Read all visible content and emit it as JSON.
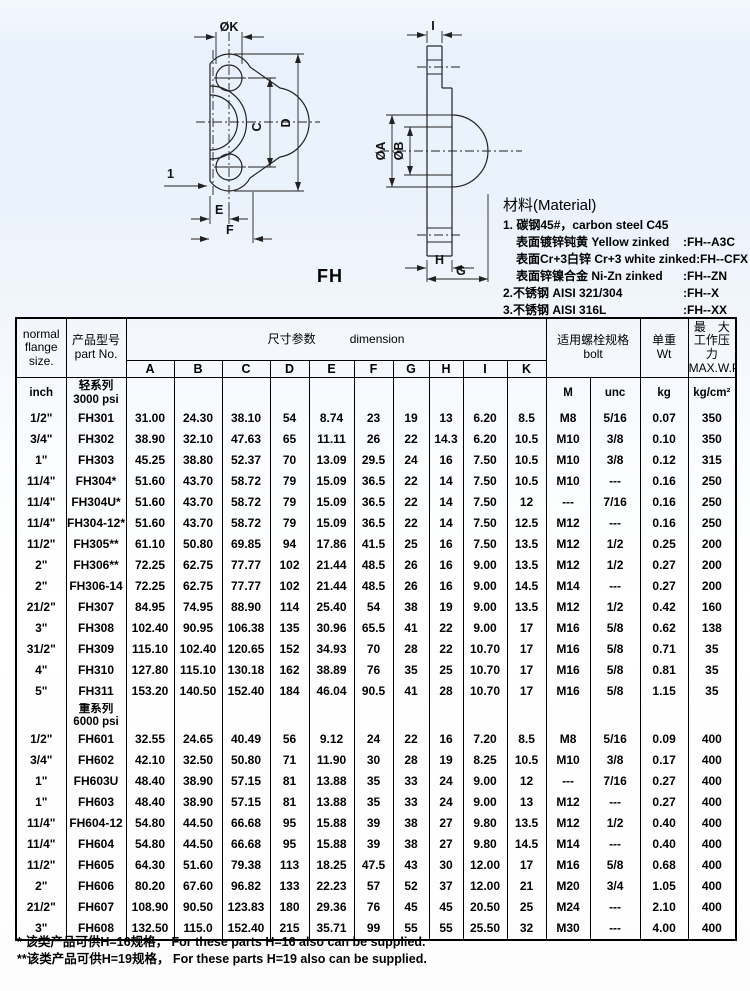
{
  "page": {
    "title": "FH"
  },
  "drawing": {
    "front": {
      "dia_k": "ØK",
      "c": "C",
      "d": "D",
      "chamfer": "1",
      "e": "E",
      "f": "F"
    },
    "side": {
      "i": "I",
      "dia_a": "ØA",
      "dia_b": "ØB",
      "h": "H",
      "g": "G"
    }
  },
  "material": {
    "heading": "材料(Material)",
    "lines": [
      {
        "text": "1. 碳钢45#，carbon steel  C45",
        "code": ""
      },
      {
        "text": "表面镀锌钝黄  Yellow zinked",
        "code": ":FH--A3C"
      },
      {
        "text": "表面Cr+3白锌  Cr+3 white zinked",
        "code": ":FH--CFX"
      },
      {
        "text": "表面锌镍合金  Ni-Zn zinked",
        "code": ":FH--ZN"
      },
      {
        "text": "2.不锈钢  AISI 321/304",
        "code": ":FH--X"
      },
      {
        "text": "3.不锈钢  AISI 316L",
        "code": ":FH--XX"
      }
    ]
  },
  "table": {
    "headers": {
      "size": "normal\nflange\nsize.",
      "part": "产品型号\npart No.",
      "dim_cn": "尺寸参数",
      "dim_en": "dimension",
      "bolt": "适用螺栓规格\nbolt",
      "wt": "单重\nWt",
      "maxwp": "最　大\n工作压力\nMAX.W.P"
    },
    "dim_letters": [
      "A",
      "B",
      "C",
      "D",
      "E",
      "F",
      "G",
      "H",
      "I",
      "K"
    ],
    "units_row": [
      "inch",
      "轻系列\n3000 psi",
      "",
      "",
      "",
      "",
      "",
      "",
      "",
      "",
      "",
      "",
      "M",
      "unc",
      "kg",
      "kg/cm²"
    ],
    "rows_light": [
      [
        "1/2\"",
        "FH301",
        "31.00",
        "24.30",
        "38.10",
        "54",
        "8.74",
        "23",
        "19",
        "13",
        "6.20",
        "8.5",
        "M8",
        "5/16",
        "0.07",
        "350"
      ],
      [
        "3/4\"",
        "FH302",
        "38.90",
        "32.10",
        "47.63",
        "65",
        "11.11",
        "26",
        "22",
        "14.3",
        "6.20",
        "10.5",
        "M10",
        "3/8",
        "0.10",
        "350"
      ],
      [
        "1\"",
        "FH303",
        "45.25",
        "38.80",
        "52.37",
        "70",
        "13.09",
        "29.5",
        "24",
        "16",
        "7.50",
        "10.5",
        "M10",
        "3/8",
        "0.12",
        "315"
      ],
      [
        "11/4\"",
        "FH304*",
        "51.60",
        "43.70",
        "58.72",
        "79",
        "15.09",
        "36.5",
        "22",
        "14",
        "7.50",
        "10.5",
        "M10",
        "---",
        "0.16",
        "250"
      ],
      [
        "11/4\"",
        "FH304U*",
        "51.60",
        "43.70",
        "58.72",
        "79",
        "15.09",
        "36.5",
        "22",
        "14",
        "7.50",
        "12",
        "---",
        "7/16",
        "0.16",
        "250"
      ],
      [
        "11/4\"",
        "FH304-12*",
        "51.60",
        "43.70",
        "58.72",
        "79",
        "15.09",
        "36.5",
        "22",
        "14",
        "7.50",
        "12.5",
        "M12",
        "---",
        "0.16",
        "250"
      ],
      [
        "11/2\"",
        "FH305**",
        "61.10",
        "50.80",
        "69.85",
        "94",
        "17.86",
        "41.5",
        "25",
        "16",
        "7.50",
        "13.5",
        "M12",
        "1/2",
        "0.25",
        "200"
      ],
      [
        "2\"",
        "FH306**",
        "72.25",
        "62.75",
        "77.77",
        "102",
        "21.44",
        "48.5",
        "26",
        "16",
        "9.00",
        "13.5",
        "M12",
        "1/2",
        "0.27",
        "200"
      ],
      [
        "2\"",
        "FH306-14",
        "72.25",
        "62.75",
        "77.77",
        "102",
        "21.44",
        "48.5",
        "26",
        "16",
        "9.00",
        "14.5",
        "M14",
        "---",
        "0.27",
        "200"
      ],
      [
        "21/2\"",
        "FH307",
        "84.95",
        "74.95",
        "88.90",
        "114",
        "25.40",
        "54",
        "38",
        "19",
        "9.00",
        "13.5",
        "M12",
        "1/2",
        "0.42",
        "160"
      ],
      [
        "3\"",
        "FH308",
        "102.40",
        "90.95",
        "106.38",
        "135",
        "30.96",
        "65.5",
        "41",
        "22",
        "9.00",
        "17",
        "M16",
        "5/8",
        "0.62",
        "138"
      ],
      [
        "31/2\"",
        "FH309",
        "115.10",
        "102.40",
        "120.65",
        "152",
        "34.93",
        "70",
        "28",
        "22",
        "10.70",
        "17",
        "M16",
        "5/8",
        "0.71",
        "35"
      ],
      [
        "4\"",
        "FH310",
        "127.80",
        "115.10",
        "130.18",
        "162",
        "38.89",
        "76",
        "35",
        "25",
        "10.70",
        "17",
        "M16",
        "5/8",
        "0.81",
        "35"
      ],
      [
        "5\"",
        "FH311",
        "153.20",
        "140.50",
        "152.40",
        "184",
        "46.04",
        "90.5",
        "41",
        "28",
        "10.70",
        "17",
        "M16",
        "5/8",
        "1.15",
        "35"
      ]
    ],
    "series_row": [
      "",
      "重系列\n6000 psi",
      "",
      "",
      "",
      "",
      "",
      "",
      "",
      "",
      "",
      "",
      "",
      "",
      "",
      ""
    ],
    "rows_heavy": [
      [
        "1/2\"",
        "FH601",
        "32.55",
        "24.65",
        "40.49",
        "56",
        "9.12",
        "24",
        "22",
        "16",
        "7.20",
        "8.5",
        "M8",
        "5/16",
        "0.09",
        "400"
      ],
      [
        "3/4\"",
        "FH602",
        "42.10",
        "32.50",
        "50.80",
        "71",
        "11.90",
        "30",
        "28",
        "19",
        "8.25",
        "10.5",
        "M10",
        "3/8",
        "0.17",
        "400"
      ],
      [
        "1\"",
        "FH603U",
        "48.40",
        "38.90",
        "57.15",
        "81",
        "13.88",
        "35",
        "33",
        "24",
        "9.00",
        "12",
        "---",
        "7/16",
        "0.27",
        "400"
      ],
      [
        "1\"",
        "FH603",
        "48.40",
        "38.90",
        "57.15",
        "81",
        "13.88",
        "35",
        "33",
        "24",
        "9.00",
        "13",
        "M12",
        "---",
        "0.27",
        "400"
      ],
      [
        "11/4\"",
        "FH604-12",
        "54.80",
        "44.50",
        "66.68",
        "95",
        "15.88",
        "39",
        "38",
        "27",
        "9.80",
        "13.5",
        "M12",
        "1/2",
        "0.40",
        "400"
      ],
      [
        "11/4\"",
        "FH604",
        "54.80",
        "44.50",
        "66.68",
        "95",
        "15.88",
        "39",
        "38",
        "27",
        "9.80",
        "14.5",
        "M14",
        "---",
        "0.40",
        "400"
      ],
      [
        "11/2\"",
        "FH605",
        "64.30",
        "51.60",
        "79.38",
        "113",
        "18.25",
        "47.5",
        "43",
        "30",
        "12.00",
        "17",
        "M16",
        "5/8",
        "0.68",
        "400"
      ],
      [
        "2\"",
        "FH606",
        "80.20",
        "67.60",
        "96.82",
        "133",
        "22.23",
        "57",
        "52",
        "37",
        "12.00",
        "21",
        "M20",
        "3/4",
        "1.05",
        "400"
      ],
      [
        "21/2\"",
        "FH607",
        "108.90",
        "90.50",
        "123.83",
        "180",
        "29.36",
        "76",
        "45",
        "45",
        "20.50",
        "25",
        "M24",
        "---",
        "2.10",
        "400"
      ],
      [
        "3\"",
        "FH608",
        "132.50",
        "115.0",
        "152.40",
        "215",
        "35.71",
        "99",
        "55",
        "55",
        "25.50",
        "32",
        "M30",
        "---",
        "4.00",
        "400"
      ]
    ]
  },
  "footnotes": [
    "* 该类产品可供H=16规格， For these parts H=16 also can be supplied.",
    "**该类产品可供H=19规格， For these parts H=19 also can be supplied."
  ]
}
